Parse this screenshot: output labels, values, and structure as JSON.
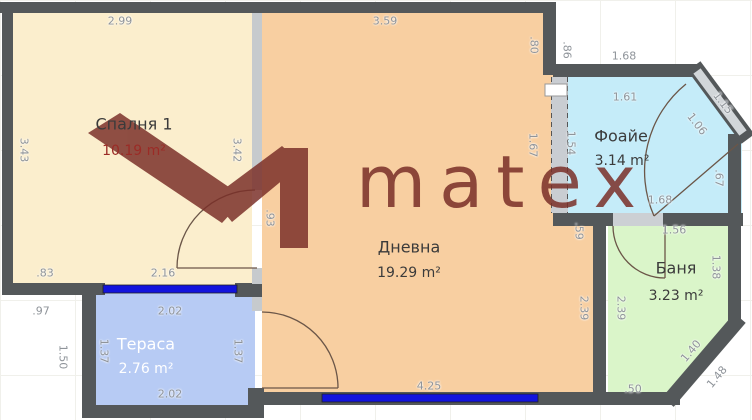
{
  "watermark": {
    "wordmark": "matex",
    "color": "#7a2f28"
  },
  "colors": {
    "wall_dark": "#54585a",
    "wall_light": "#c6cacd",
    "window": "#1313dd",
    "dim_text": "#8f949a"
  },
  "rooms": [
    {
      "id": "bedroom",
      "name": "Спалня 1",
      "area": "10.19 m²",
      "color": "#fbeecd",
      "nx": 134,
      "ny": 124,
      "ax": 134,
      "ay": 151,
      "name_color": "#3b3b3b",
      "area_color": "#9b2b26"
    },
    {
      "id": "living",
      "name": "Дневна",
      "area": "19.29 m²",
      "color": "#f8cfa1",
      "nx": 409,
      "ny": 247,
      "ax": 409,
      "ay": 273,
      "name_color": "#3b3b3b",
      "area_color": "#3b3b3b"
    },
    {
      "id": "foyer",
      "name": "Фоайе",
      "area": "3.14 m²",
      "color": "#c5ecf9",
      "nx": 621,
      "ny": 136,
      "ax": 622,
      "ay": 161,
      "name_color": "#3b3b3b",
      "area_color": "#3b3b3b"
    },
    {
      "id": "bath",
      "name": "Баня",
      "area": "3.23 m²",
      "color": "#daf5c9",
      "nx": 676,
      "ny": 268,
      "ax": 676,
      "ay": 296,
      "name_color": "#3b3b3b",
      "area_color": "#3b3b3b"
    },
    {
      "id": "terrace",
      "name": "Тераса",
      "area": "2.76 m²",
      "color": "#b7cbf4",
      "nx": 146,
      "ny": 344,
      "ax": 146,
      "ay": 369,
      "name_color": "#ffffff",
      "area_color": "#ffffff"
    }
  ],
  "dimensions": [
    {
      "t": "2.99",
      "x": 120,
      "y": 21,
      "r": 0
    },
    {
      "t": "3.59",
      "x": 385,
      "y": 21,
      "r": 0
    },
    {
      "t": ".80",
      "x": 534,
      "y": 45,
      "r": 90
    },
    {
      "t": ".86",
      "x": 567,
      "y": 50,
      "r": 90
    },
    {
      "t": "1.68",
      "x": 624,
      "y": 56,
      "r": 0
    },
    {
      "t": "1.61",
      "x": 625,
      "y": 97,
      "r": 0
    },
    {
      "t": "1.15",
      "x": 723,
      "y": 103,
      "r": 52
    },
    {
      "t": "1.06",
      "x": 697,
      "y": 124,
      "r": 52
    },
    {
      "t": "1.54",
      "x": 571,
      "y": 143,
      "r": 90
    },
    {
      "t": "1.67",
      "x": 533,
      "y": 145,
      "r": 90
    },
    {
      "t": ".67",
      "x": 719,
      "y": 178,
      "r": 90
    },
    {
      "t": "1.68",
      "x": 660,
      "y": 200,
      "r": 0
    },
    {
      "t": ".59",
      "x": 579,
      "y": 231,
      "r": 90
    },
    {
      "t": "1.56",
      "x": 674,
      "y": 230,
      "r": 0
    },
    {
      "t": "1.38",
      "x": 716,
      "y": 267,
      "r": 90
    },
    {
      "t": "2.39",
      "x": 584,
      "y": 308,
      "r": 90
    },
    {
      "t": "2.39",
      "x": 621,
      "y": 308,
      "r": 90
    },
    {
      "t": "1.40",
      "x": 691,
      "y": 351,
      "r": -50
    },
    {
      "t": "1.48",
      "x": 717,
      "y": 377,
      "r": -50
    },
    {
      "t": ".50",
      "x": 633,
      "y": 389,
      "r": 0
    },
    {
      "t": "4.25",
      "x": 429,
      "y": 386,
      "r": 0
    },
    {
      "t": "3.43",
      "x": 24,
      "y": 150,
      "r": 90
    },
    {
      "t": "3.42",
      "x": 237,
      "y": 150,
      "r": 90
    },
    {
      "t": ".93",
      "x": 270,
      "y": 218,
      "r": 90
    },
    {
      "t": ".83",
      "x": 45,
      "y": 273,
      "r": 0
    },
    {
      "t": "2.16",
      "x": 163,
      "y": 273,
      "r": 0
    },
    {
      "t": ".97",
      "x": 41,
      "y": 311,
      "r": 0
    },
    {
      "t": "1.50",
      "x": 63,
      "y": 357,
      "r": 90
    },
    {
      "t": "2.02",
      "x": 170,
      "y": 311,
      "r": 0
    },
    {
      "t": "1.37",
      "x": 104,
      "y": 351,
      "r": 90
    },
    {
      "t": "1.37",
      "x": 238,
      "y": 351,
      "r": 90
    },
    {
      "t": "2.02",
      "x": 170,
      "y": 394,
      "r": 0
    }
  ]
}
